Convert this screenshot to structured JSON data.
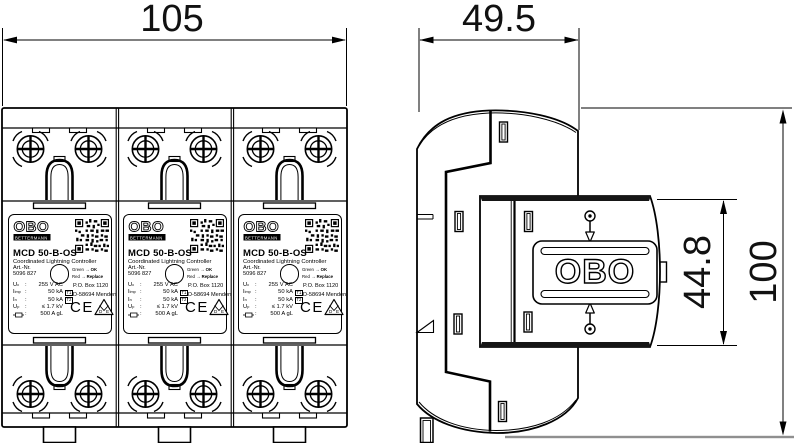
{
  "dimensions": {
    "front_width_mm": "105",
    "side_depth_mm": "49.5",
    "module_height_mm": "44.8",
    "total_height_mm": "100"
  },
  "device_label": {
    "brand": "OBO",
    "brand_sub": "BETTERMANN",
    "model": "MCD 50-B-OS",
    "subtitle": "Coordinated Lightning Controller",
    "art_label": "Art.-Nr.",
    "art_number": "5096 827",
    "separator": ":",
    "indicator": {
      "green_label": "Green",
      "green_state": "OK",
      "red_label": "Red",
      "red_state": "Replace",
      "arrow": "→"
    },
    "specs": [
      {
        "symbol": "U",
        "sub": "c",
        "value": "255 V AC",
        "tag": ""
      },
      {
        "symbol": "I",
        "sub": "imp",
        "value": "50 kA",
        "tag": "T1"
      },
      {
        "symbol": "I",
        "sub": "n",
        "value": "50 kA",
        "tag": "T2"
      },
      {
        "symbol": "U",
        "sub": "p",
        "value": "≤ 1.7 kV",
        "tag": ""
      },
      {
        "symbol": "",
        "sub": "",
        "value": "500 A gL",
        "tag": ""
      }
    ],
    "address_line1": "P.O. Box 1120",
    "address_line2": "D-58694 Menden",
    "ce_mark": "CE",
    "vde_d": "D",
    "vde_e": "E"
  },
  "side_view": {
    "logo": "OBO"
  }
}
